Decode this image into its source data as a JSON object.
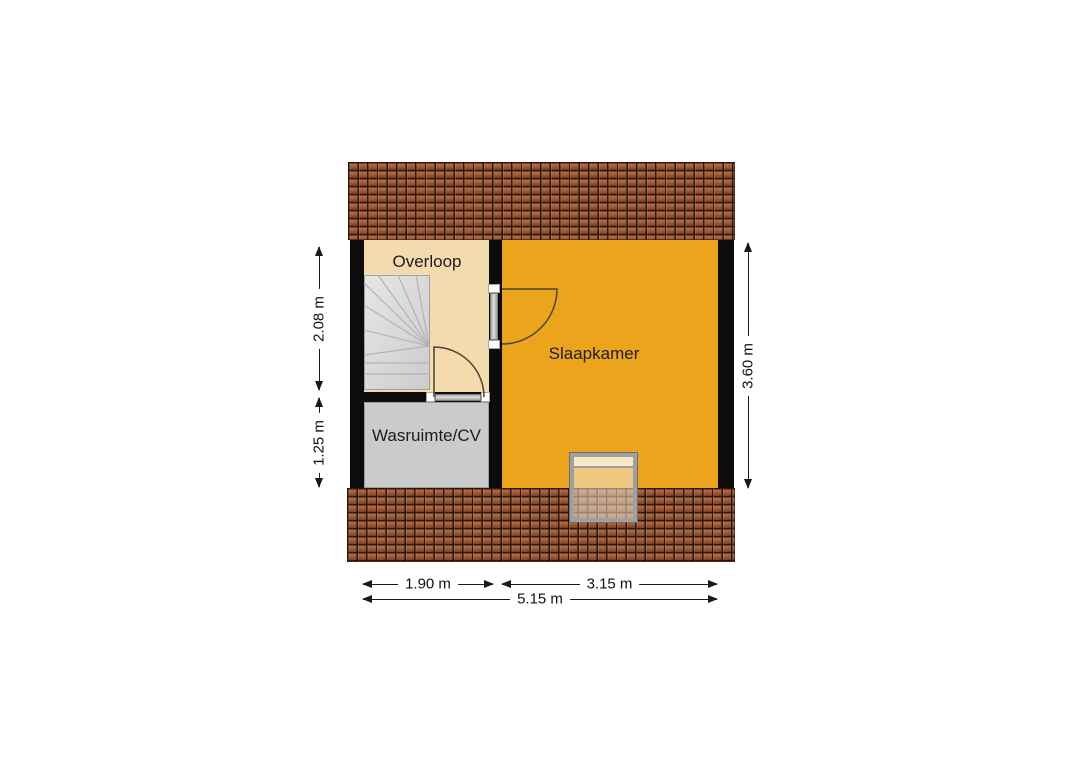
{
  "floorplan": {
    "type": "floor-plan",
    "floor": "attic",
    "rooms": [
      {
        "name": "Overloop",
        "color": "#f4dbae"
      },
      {
        "name": "Slaapkamer",
        "color": "#eba41c"
      },
      {
        "name": "Wasruimte/CV",
        "color": "#cbcbc9"
      }
    ],
    "dimensions": {
      "left_upper": "2.08 m",
      "left_lower": "1.25 m",
      "right_side": "3.60 m",
      "bottom_left": "1.90 m",
      "bottom_right": "3.15 m",
      "bottom_total": "5.15 m"
    },
    "features": [
      "roof-top",
      "roof-bottom",
      "stairs",
      "door-to-slaapkamer",
      "door-in-overloop",
      "skylight-window"
    ],
    "colors": {
      "wall": "#0c0c0c",
      "roof_tile": "#a25a33",
      "stairs": "#d9d9d9",
      "dimension_text": "#111111",
      "background": "#ffffff"
    }
  }
}
